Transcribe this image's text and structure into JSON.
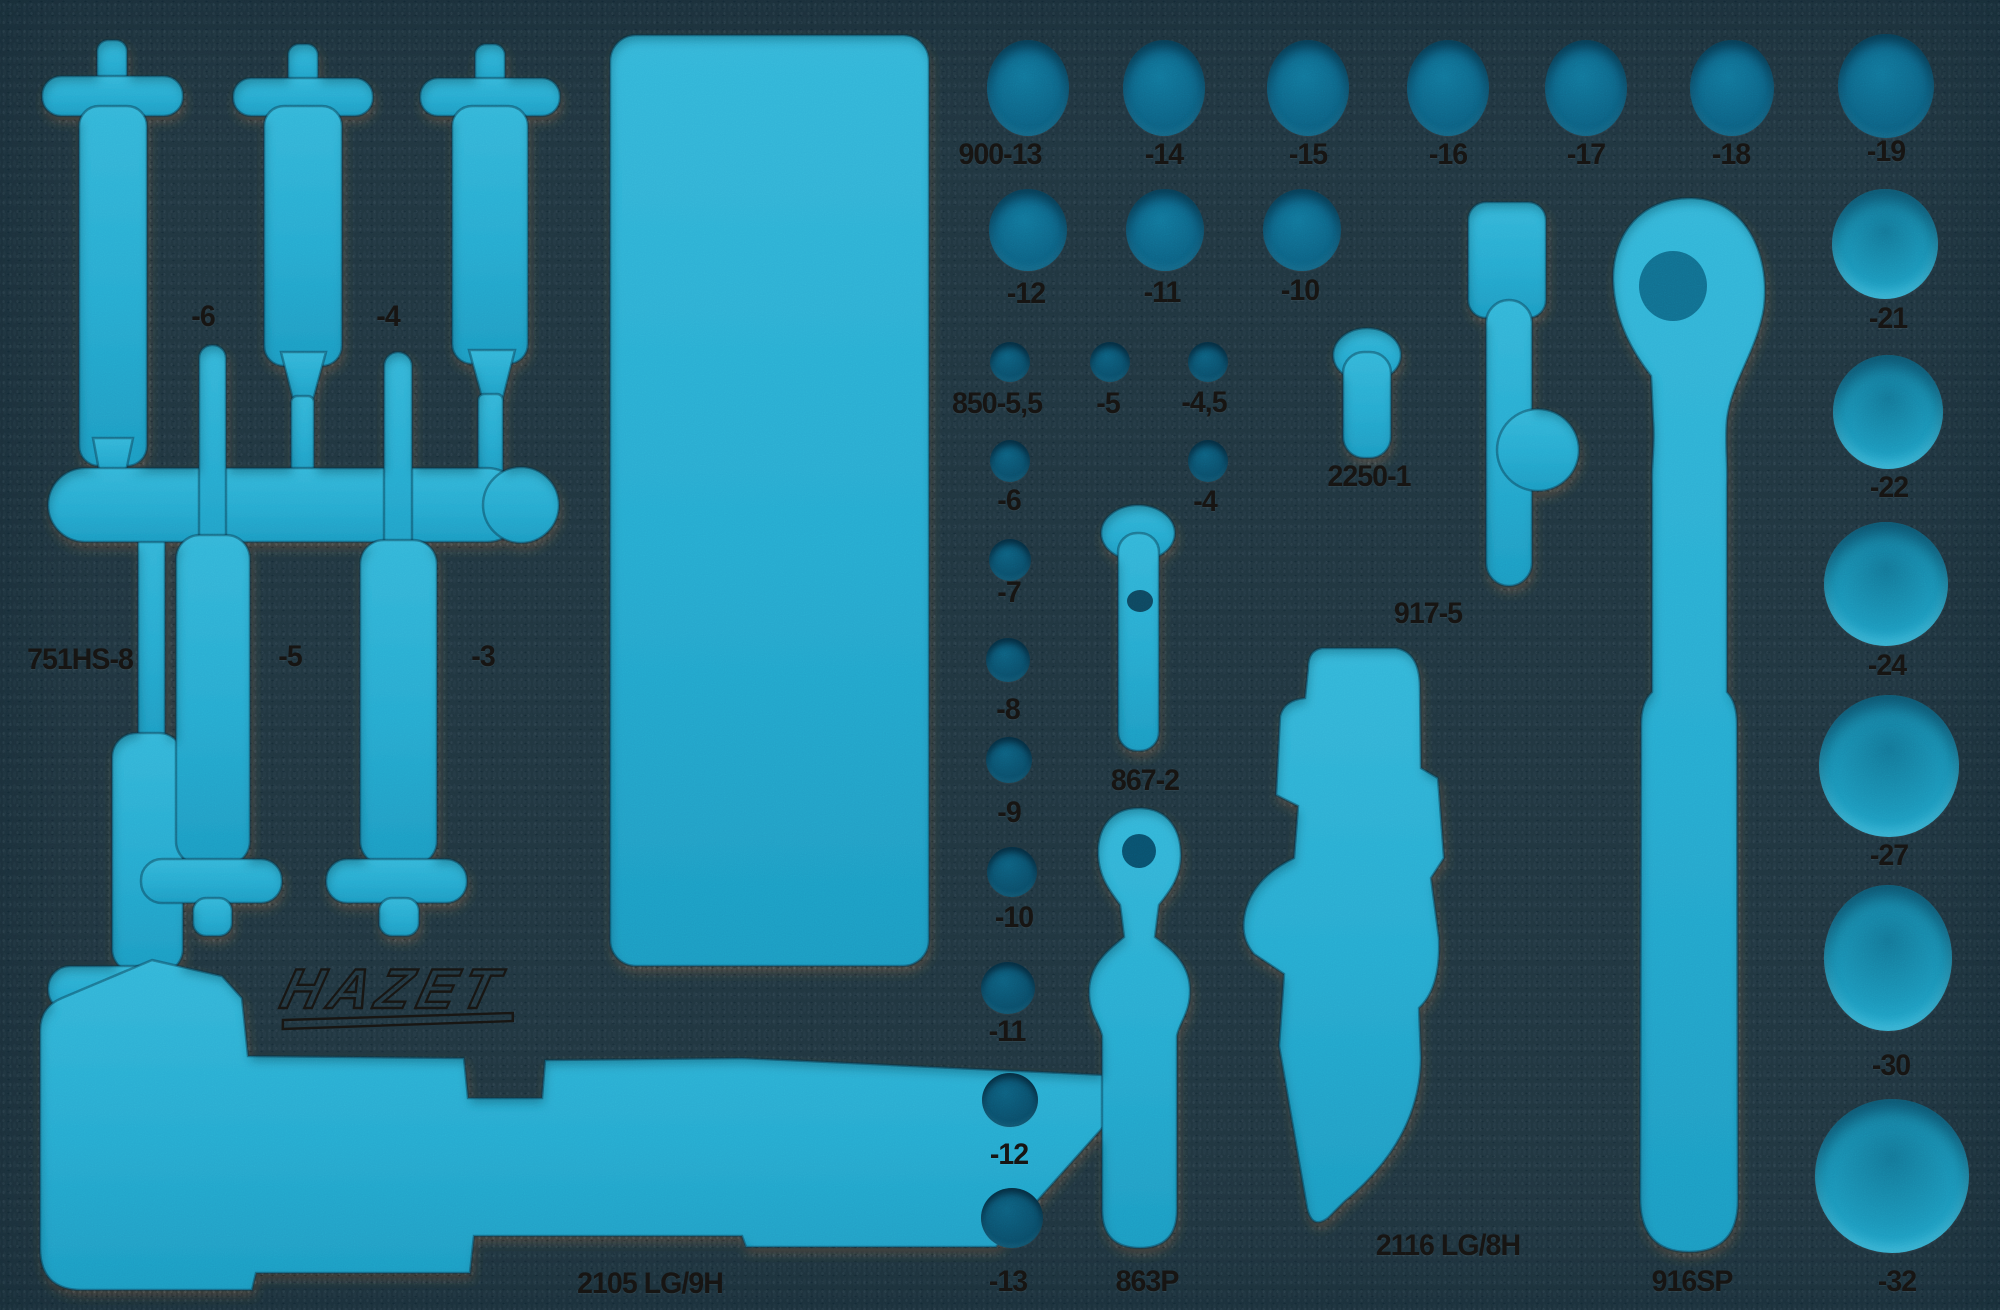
{
  "image_type": "product photo of a two-color foam tool tray inlay",
  "brand": {
    "logo_text": "HAZET"
  },
  "colors": {
    "foam_gray": "#47443f",
    "cutout_blue": "#2badd2",
    "cutout_blue_deep": "#1e9dc4",
    "hole_teal_dark": "#0a4c68",
    "hole_teal_medium": "#0d6284",
    "hole_teal_light": "#1b94b8",
    "engraving_black": "#171513"
  },
  "tool_sets": {
    "screwdrivers_751": [
      "751HS-8",
      "-6",
      "-5",
      "-4",
      "-3"
    ],
    "sockets_900": [
      "900-13",
      "-14",
      "-15",
      "-16",
      "-17",
      "-18",
      "-19",
      "-12",
      "-11",
      "-10",
      "-21",
      "-22",
      "-24",
      "-27",
      "-30",
      "-32"
    ],
    "bits_850": [
      "850-5,5",
      "-5",
      "-4,5",
      "-6",
      "-4",
      "-7",
      "-8",
      "-9",
      "-10",
      "-11",
      "-12",
      "-13"
    ],
    "single_parts": [
      "2250-1",
      "917-5",
      "867-2",
      "863P",
      "2105 LG/9H",
      "2116 LG/8H",
      "916SP"
    ]
  },
  "labels": {
    "l_900_13": "900-13",
    "l_900_14": "-14",
    "l_900_15": "-15",
    "l_900_16": "-16",
    "l_900_17": "-17",
    "l_900_18": "-18",
    "l_900_19": "-19",
    "l_900_12": "-12",
    "l_900_11": "-11",
    "l_900_10": "-10",
    "l_900_21": "-21",
    "l_900_22": "-22",
    "l_900_24": "-24",
    "l_900_27": "-27",
    "l_900_30": "-30",
    "l_900_32": "-32",
    "l_850_55": "850-5,5",
    "l_850_5": "-5",
    "l_850_45": "-4,5",
    "l_850_6": "-6",
    "l_850_4": "-4",
    "l_850_7": "-7",
    "l_850_8": "-8",
    "l_850_9": "-9",
    "l_850_10": "-10",
    "l_850_11": "-11",
    "l_850_12": "-12",
    "l_850_13": "-13",
    "l_751hs8": "751HS-8",
    "l_751_6": "-6",
    "l_751_5": "-5",
    "l_751_4": "-4",
    "l_751_3": "-3",
    "l_2250": "2250-1",
    "l_917": "917-5",
    "l_867": "867-2",
    "l_863": "863P",
    "l_2105": "2105 LG/9H",
    "l_2116": "2116 LG/8H",
    "l_916": "916SP"
  }
}
